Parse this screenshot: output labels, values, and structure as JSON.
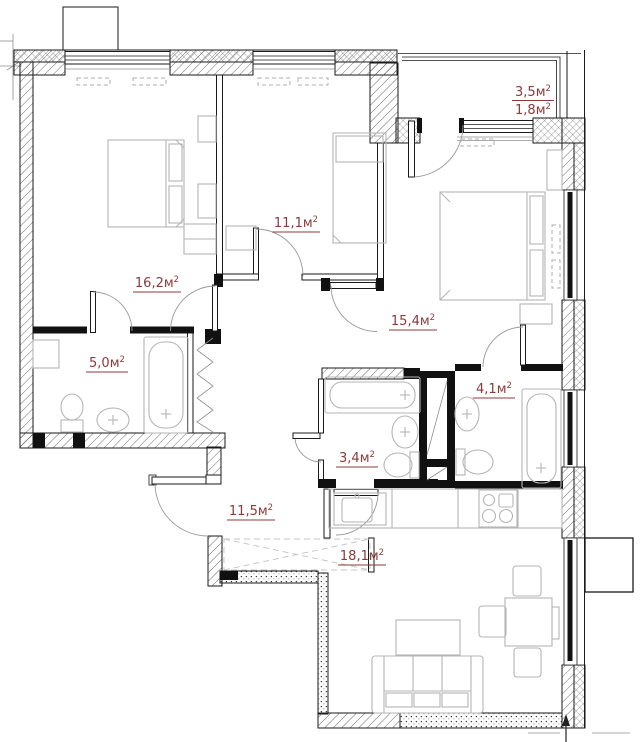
{
  "plan": {
    "unit": "м",
    "sup": "2"
  },
  "rooms": [
    {
      "id": "bedroom-1",
      "area": "16,2"
    },
    {
      "id": "bedroom-2",
      "area": "11,1"
    },
    {
      "id": "bedroom-3",
      "area": "15,4"
    },
    {
      "id": "bathroom-1",
      "area": "5,0"
    },
    {
      "id": "bathroom-2",
      "area": "3,4"
    },
    {
      "id": "bathroom-3",
      "area": "4,1"
    },
    {
      "id": "hallway",
      "area": "11,5"
    },
    {
      "id": "kitchen-living",
      "area": "18,1"
    },
    {
      "id": "balcony",
      "area_full": "3,5",
      "area_reduced": "1,8"
    }
  ],
  "colors": {
    "label": "#8c3a3a",
    "wall": "#1a1a1a",
    "furniture": "#b5b5b5"
  }
}
